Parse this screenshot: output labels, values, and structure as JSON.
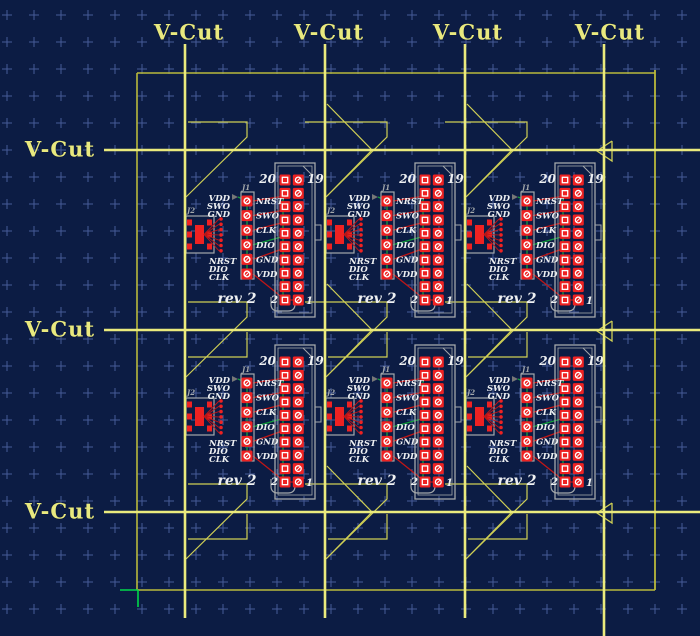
{
  "colors": {
    "background": "#0c1c44",
    "grid_cross": "#4d63a2",
    "vcut_line": "#eaea7d",
    "panel_outline": "#b9b93c",
    "edge_marker": "#cfcf55",
    "silkscreen": "#a4a8ab",
    "pad_red": "#ee2222",
    "trace_red": "#c01616",
    "trace_green": "#12a03c",
    "origin_green": "#00d84a",
    "module_text": "#eef0f2",
    "label_yellow": "#e9e97f"
  },
  "grid": {
    "origin_x": 7,
    "origin_y": 15,
    "spacing": 27,
    "arm": 5
  },
  "vcut": {
    "labels": [
      {
        "text": "V-Cut",
        "cx": 189,
        "cy": 33
      },
      {
        "text": "V-Cut",
        "cx": 329,
        "cy": 33
      },
      {
        "text": "V-Cut",
        "cx": 468,
        "cy": 33
      },
      {
        "text": "V-Cut",
        "cx": 610,
        "cy": 33
      },
      {
        "text": "V-Cut",
        "cx": 60,
        "cy": 150
      },
      {
        "text": "V-Cut",
        "cx": 60,
        "cy": 330
      },
      {
        "text": "V-Cut",
        "cx": 60,
        "cy": 512
      }
    ],
    "vertical_lines": [
      {
        "x": 185,
        "y1": 44,
        "y2": 618
      },
      {
        "x": 325,
        "y1": 44,
        "y2": 618
      },
      {
        "x": 465,
        "y1": 44,
        "y2": 618
      },
      {
        "x": 604,
        "y1": 44,
        "y2": 636
      }
    ],
    "horizontal_lines": [
      {
        "y": 150,
        "x1": 104,
        "x2": 700
      },
      {
        "y": 330,
        "x1": 104,
        "x2": 700
      },
      {
        "y": 512,
        "x1": 104,
        "x2": 700
      }
    ]
  },
  "panel": {
    "left": 137,
    "top": 73,
    "right": 655,
    "bottom": 590
  },
  "origin_marker": {
    "x": 138,
    "y": 590
  },
  "module_labels": {
    "j1": "J1",
    "j2": "J2",
    "pin20": "20",
    "pin19": "19",
    "pin2": "2",
    "pin1": "1",
    "rev": "rev 2",
    "pins": [
      "NRST",
      "SWO",
      "CLK",
      "DIO",
      "GND",
      "VDD"
    ],
    "top_stack": [
      "VDD",
      "SWO",
      "GND"
    ],
    "bottom_stack": [
      "NRST",
      "DIO",
      "CLK"
    ]
  },
  "module_origins": [
    [
      185,
      150
    ],
    [
      325,
      150
    ],
    [
      465,
      150
    ],
    [
      185,
      332
    ],
    [
      325,
      332
    ],
    [
      465,
      332
    ]
  ]
}
